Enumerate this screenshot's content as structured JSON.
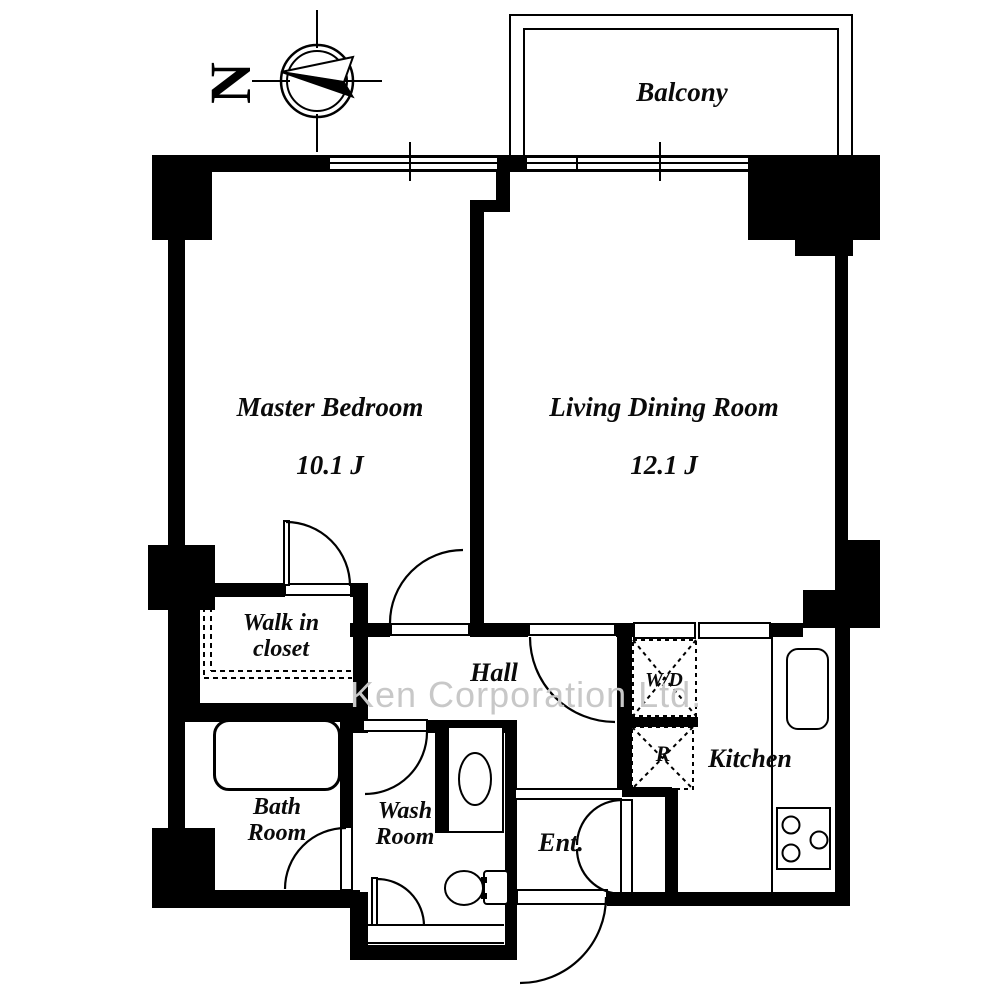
{
  "compass": {
    "north_label": "N"
  },
  "balcony": {
    "label": "Balcony"
  },
  "rooms": {
    "master_bedroom": {
      "name": "Master Bedroom",
      "size": "10.1 J"
    },
    "living_dining": {
      "name": "Living Dining Room",
      "size": "12.1 J"
    },
    "walk_in_closet": {
      "name": "Walk in\ncloset"
    },
    "hall": {
      "name": "Hall"
    },
    "bath_room": {
      "name": "Bath\nRoom"
    },
    "wash_room": {
      "name": "Wash\nRoom"
    },
    "entrance": {
      "name": "Ent."
    },
    "kitchen": {
      "name": "Kitchen"
    },
    "washer_dryer": {
      "label": "W/D"
    },
    "refrigerator": {
      "label": "R"
    }
  },
  "watermark": {
    "text": "Ken Corporation Ltd."
  },
  "colors": {
    "wall": "#000000",
    "background": "#ffffff",
    "watermark": "#c8c8c8"
  }
}
